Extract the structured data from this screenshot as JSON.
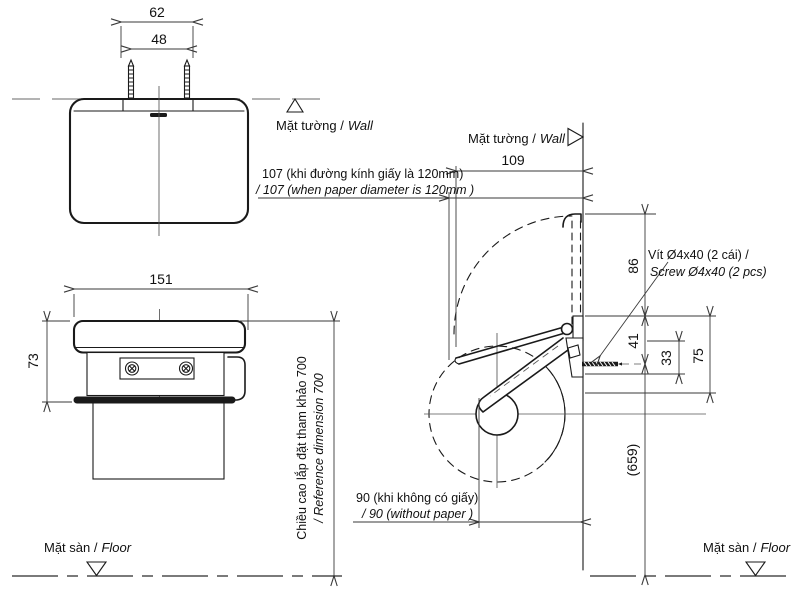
{
  "meta": {
    "kind": "technical-installation-drawing",
    "product": "paper-holder"
  },
  "colors": {
    "line": "#1a1a1a",
    "dim": "#3a3a3a",
    "wall_dash": "#9a9a9a",
    "background": "#ffffff"
  },
  "top_view": {
    "dim_62": "62",
    "dim_48": "48"
  },
  "front_view": {
    "dim_151": "151",
    "dim_73": "73"
  },
  "side_view": {
    "dim_109": "109",
    "dim_86": "86",
    "dim_41": "41",
    "dim_33": "33",
    "dim_75": "75",
    "dim_659": "(659)",
    "note_107_vi": "107 (khi đường kính giấy là 120mm)",
    "note_107_en": "/ 107 (when  paper diameter is 120mm )",
    "note_90_vi": "90 (khi không có giấy)",
    "note_90_en": "/ 90 (without paper )",
    "screw_note_vi": "Vít Ø4x40 (2 cái) /",
    "screw_note_en": "Screw Ø4x40 (2 pcs)"
  },
  "reference_height": {
    "vi": "Chiều cao lắp đặt tham khảo 700",
    "en": "/ Reference dimension 700"
  },
  "labels": {
    "wall_vi": "Mặt tường /",
    "wall_en": "Wall",
    "floor_vi": "Mặt sàn /",
    "floor_en": "Floor"
  }
}
